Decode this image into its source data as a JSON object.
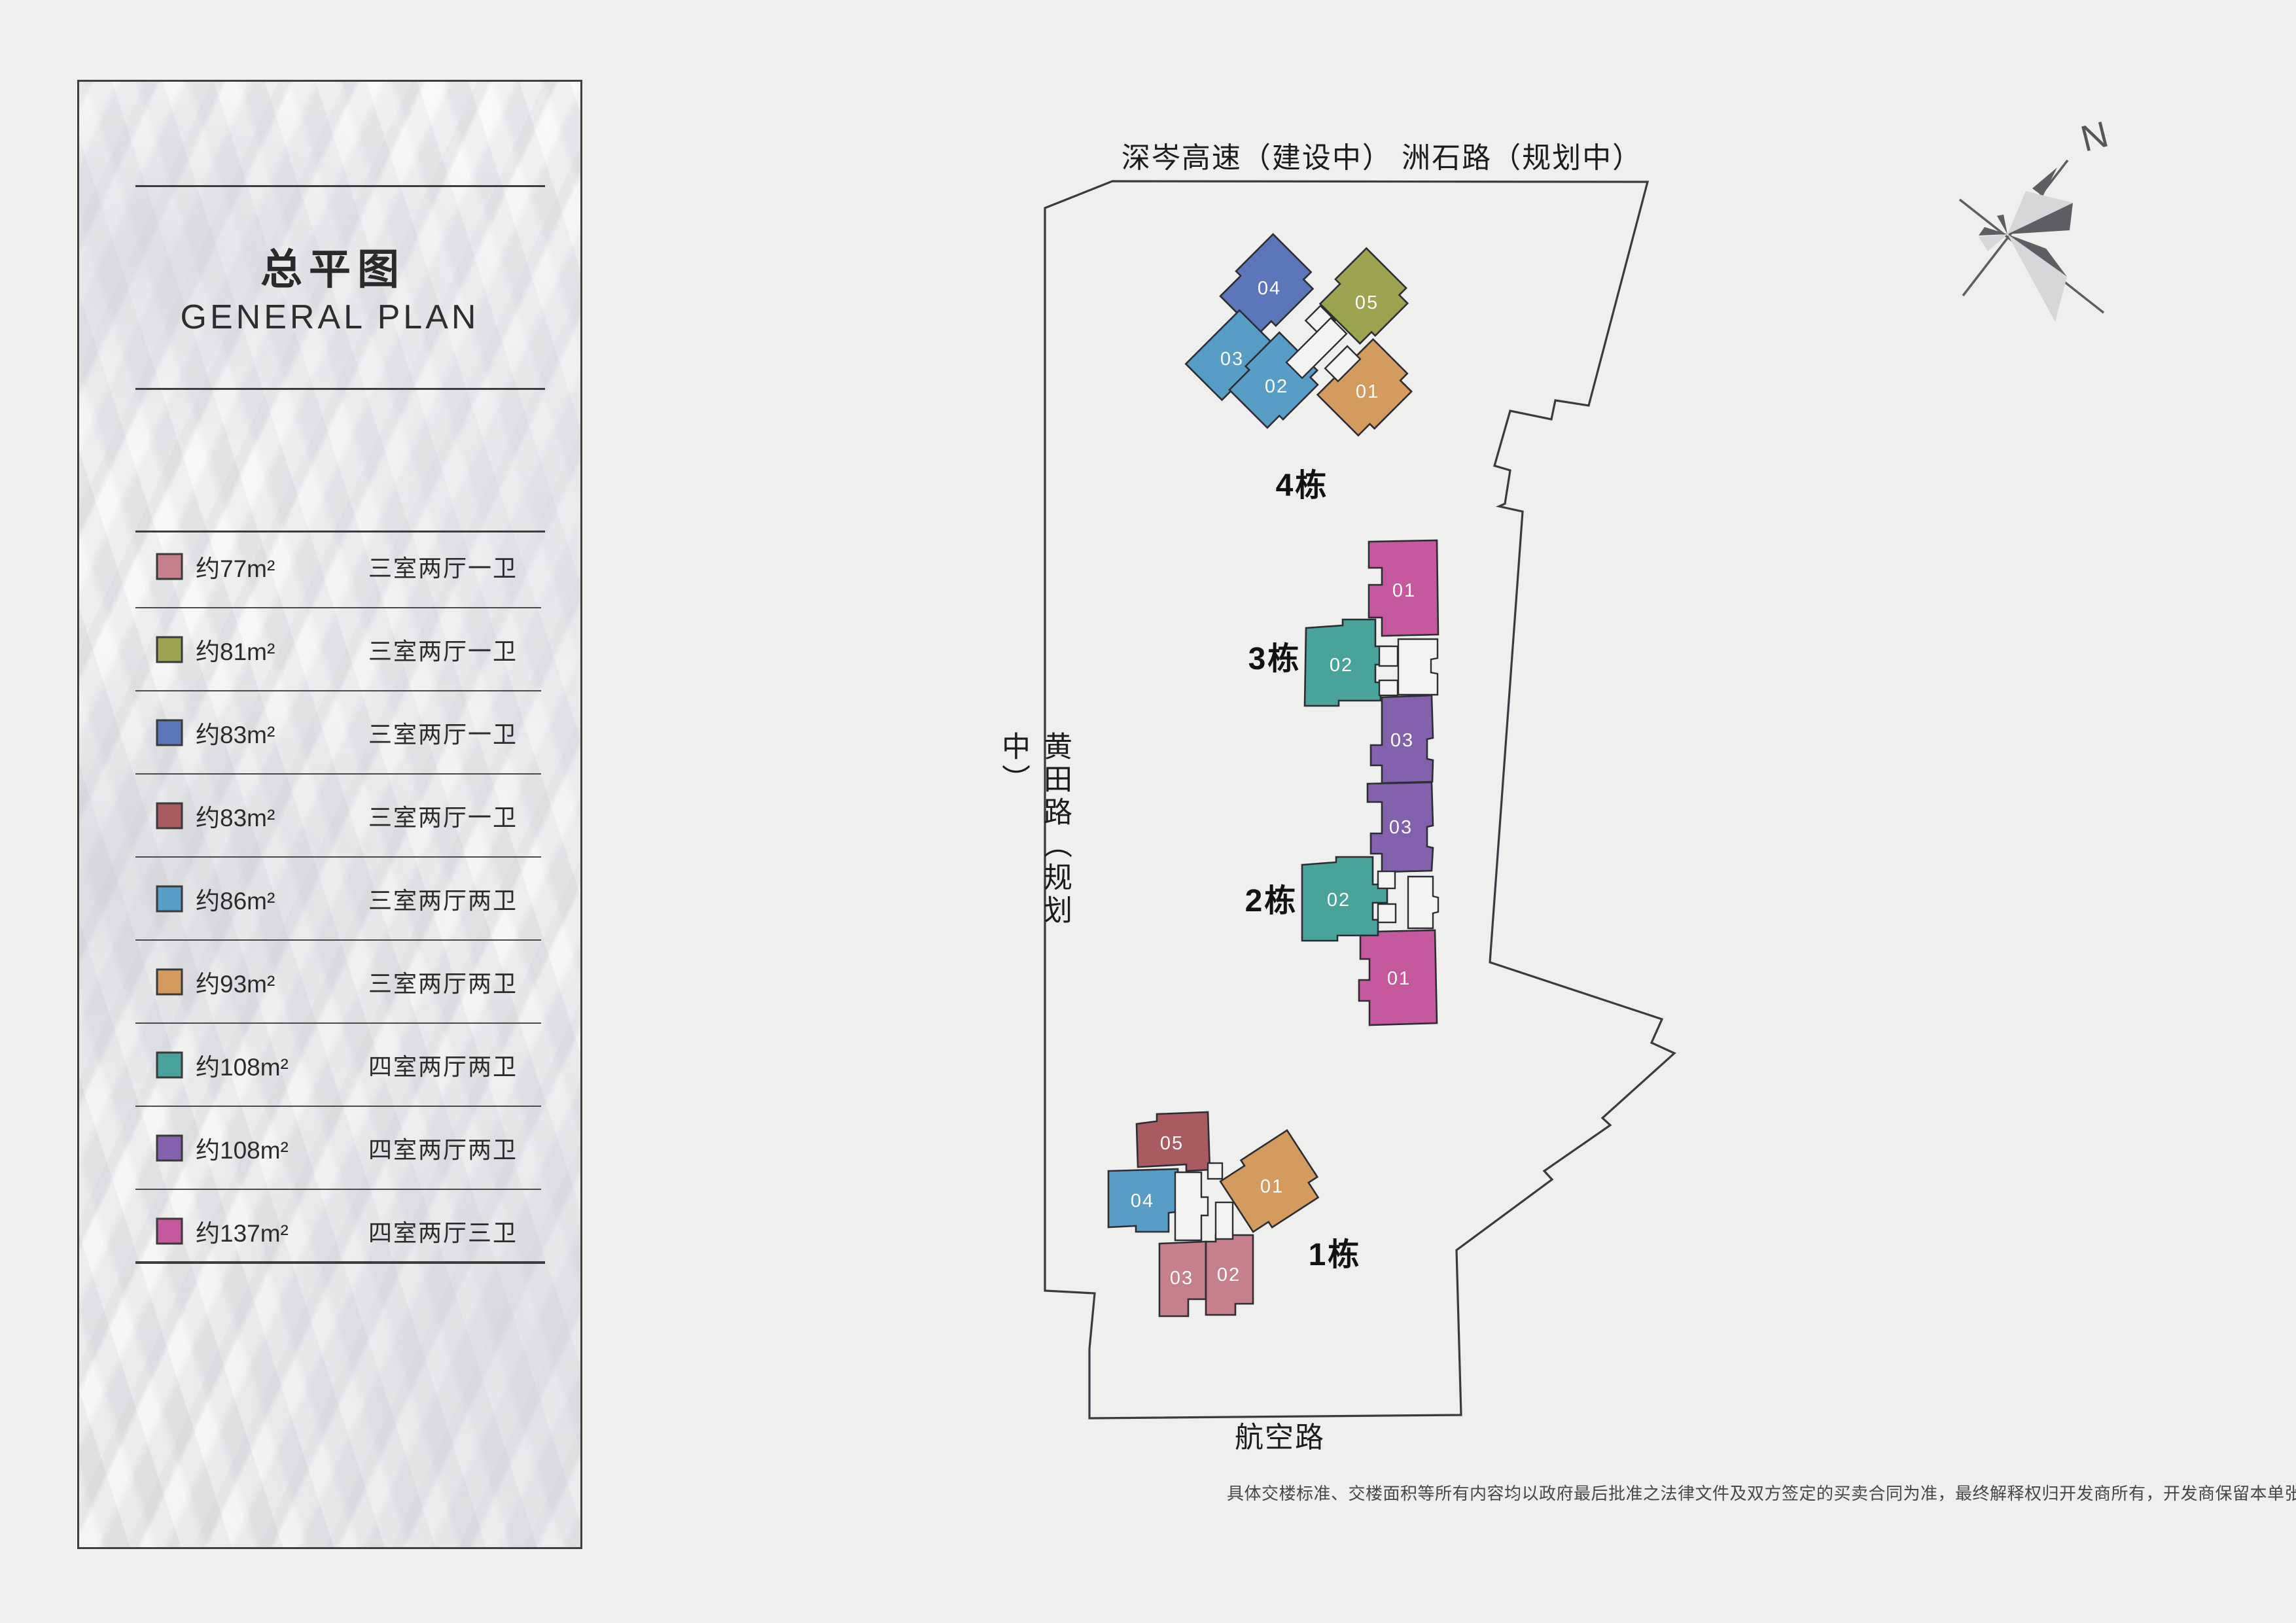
{
  "sidebar": {
    "title_cn": "总平图",
    "title_en": "GENERAL PLAN",
    "legend": [
      {
        "area": "约77m²",
        "type": "三室两厅一卫",
        "color": "#c5808c"
      },
      {
        "area": "约81m²",
        "type": "三室两厅一卫",
        "color": "#9aa451"
      },
      {
        "area": "约83m²",
        "type": "三室两厅一卫",
        "color": "#5b76b9"
      },
      {
        "area": "约83m²",
        "type": "三室两厅一卫",
        "color": "#aa5a61"
      },
      {
        "area": "约86m²",
        "type": "三室两厅两卫",
        "color": "#589dc6"
      },
      {
        "area": "约93m²",
        "type": "三室两厅两卫",
        "color": "#d39b5d"
      },
      {
        "area": "约108m²",
        "type": "四室两厅两卫",
        "color": "#49a39a"
      },
      {
        "area": "约108m²",
        "type": "四室两厅两卫",
        "color": "#8461ac"
      },
      {
        "area": "约137m²",
        "type": "四室两厅三卫",
        "color": "#c6589d"
      }
    ]
  },
  "map": {
    "roads": {
      "top": "深岑高速（建设中） 洲石路（规划中）",
      "left": "黄田路（规划中）",
      "bottom": "航空路"
    },
    "compass": {
      "label": "N"
    },
    "blocks": [
      {
        "name": "4栋",
        "units": [
          "04",
          "05",
          "03",
          "02",
          "01"
        ]
      },
      {
        "name": "3栋",
        "units": [
          "01",
          "02",
          "03"
        ]
      },
      {
        "name": "2栋",
        "units": [
          "03",
          "02",
          "01"
        ]
      },
      {
        "name": "1栋",
        "units": [
          "05",
          "04",
          "01",
          "03",
          "02"
        ]
      }
    ]
  },
  "footer": {
    "disclaimer": "具体交楼标准、交楼面积等所有内容均以政府最后批准之法律文件及双方签定的买卖合同为准，最终解释权归开发商所有，开发商保留本单张修改权利"
  }
}
